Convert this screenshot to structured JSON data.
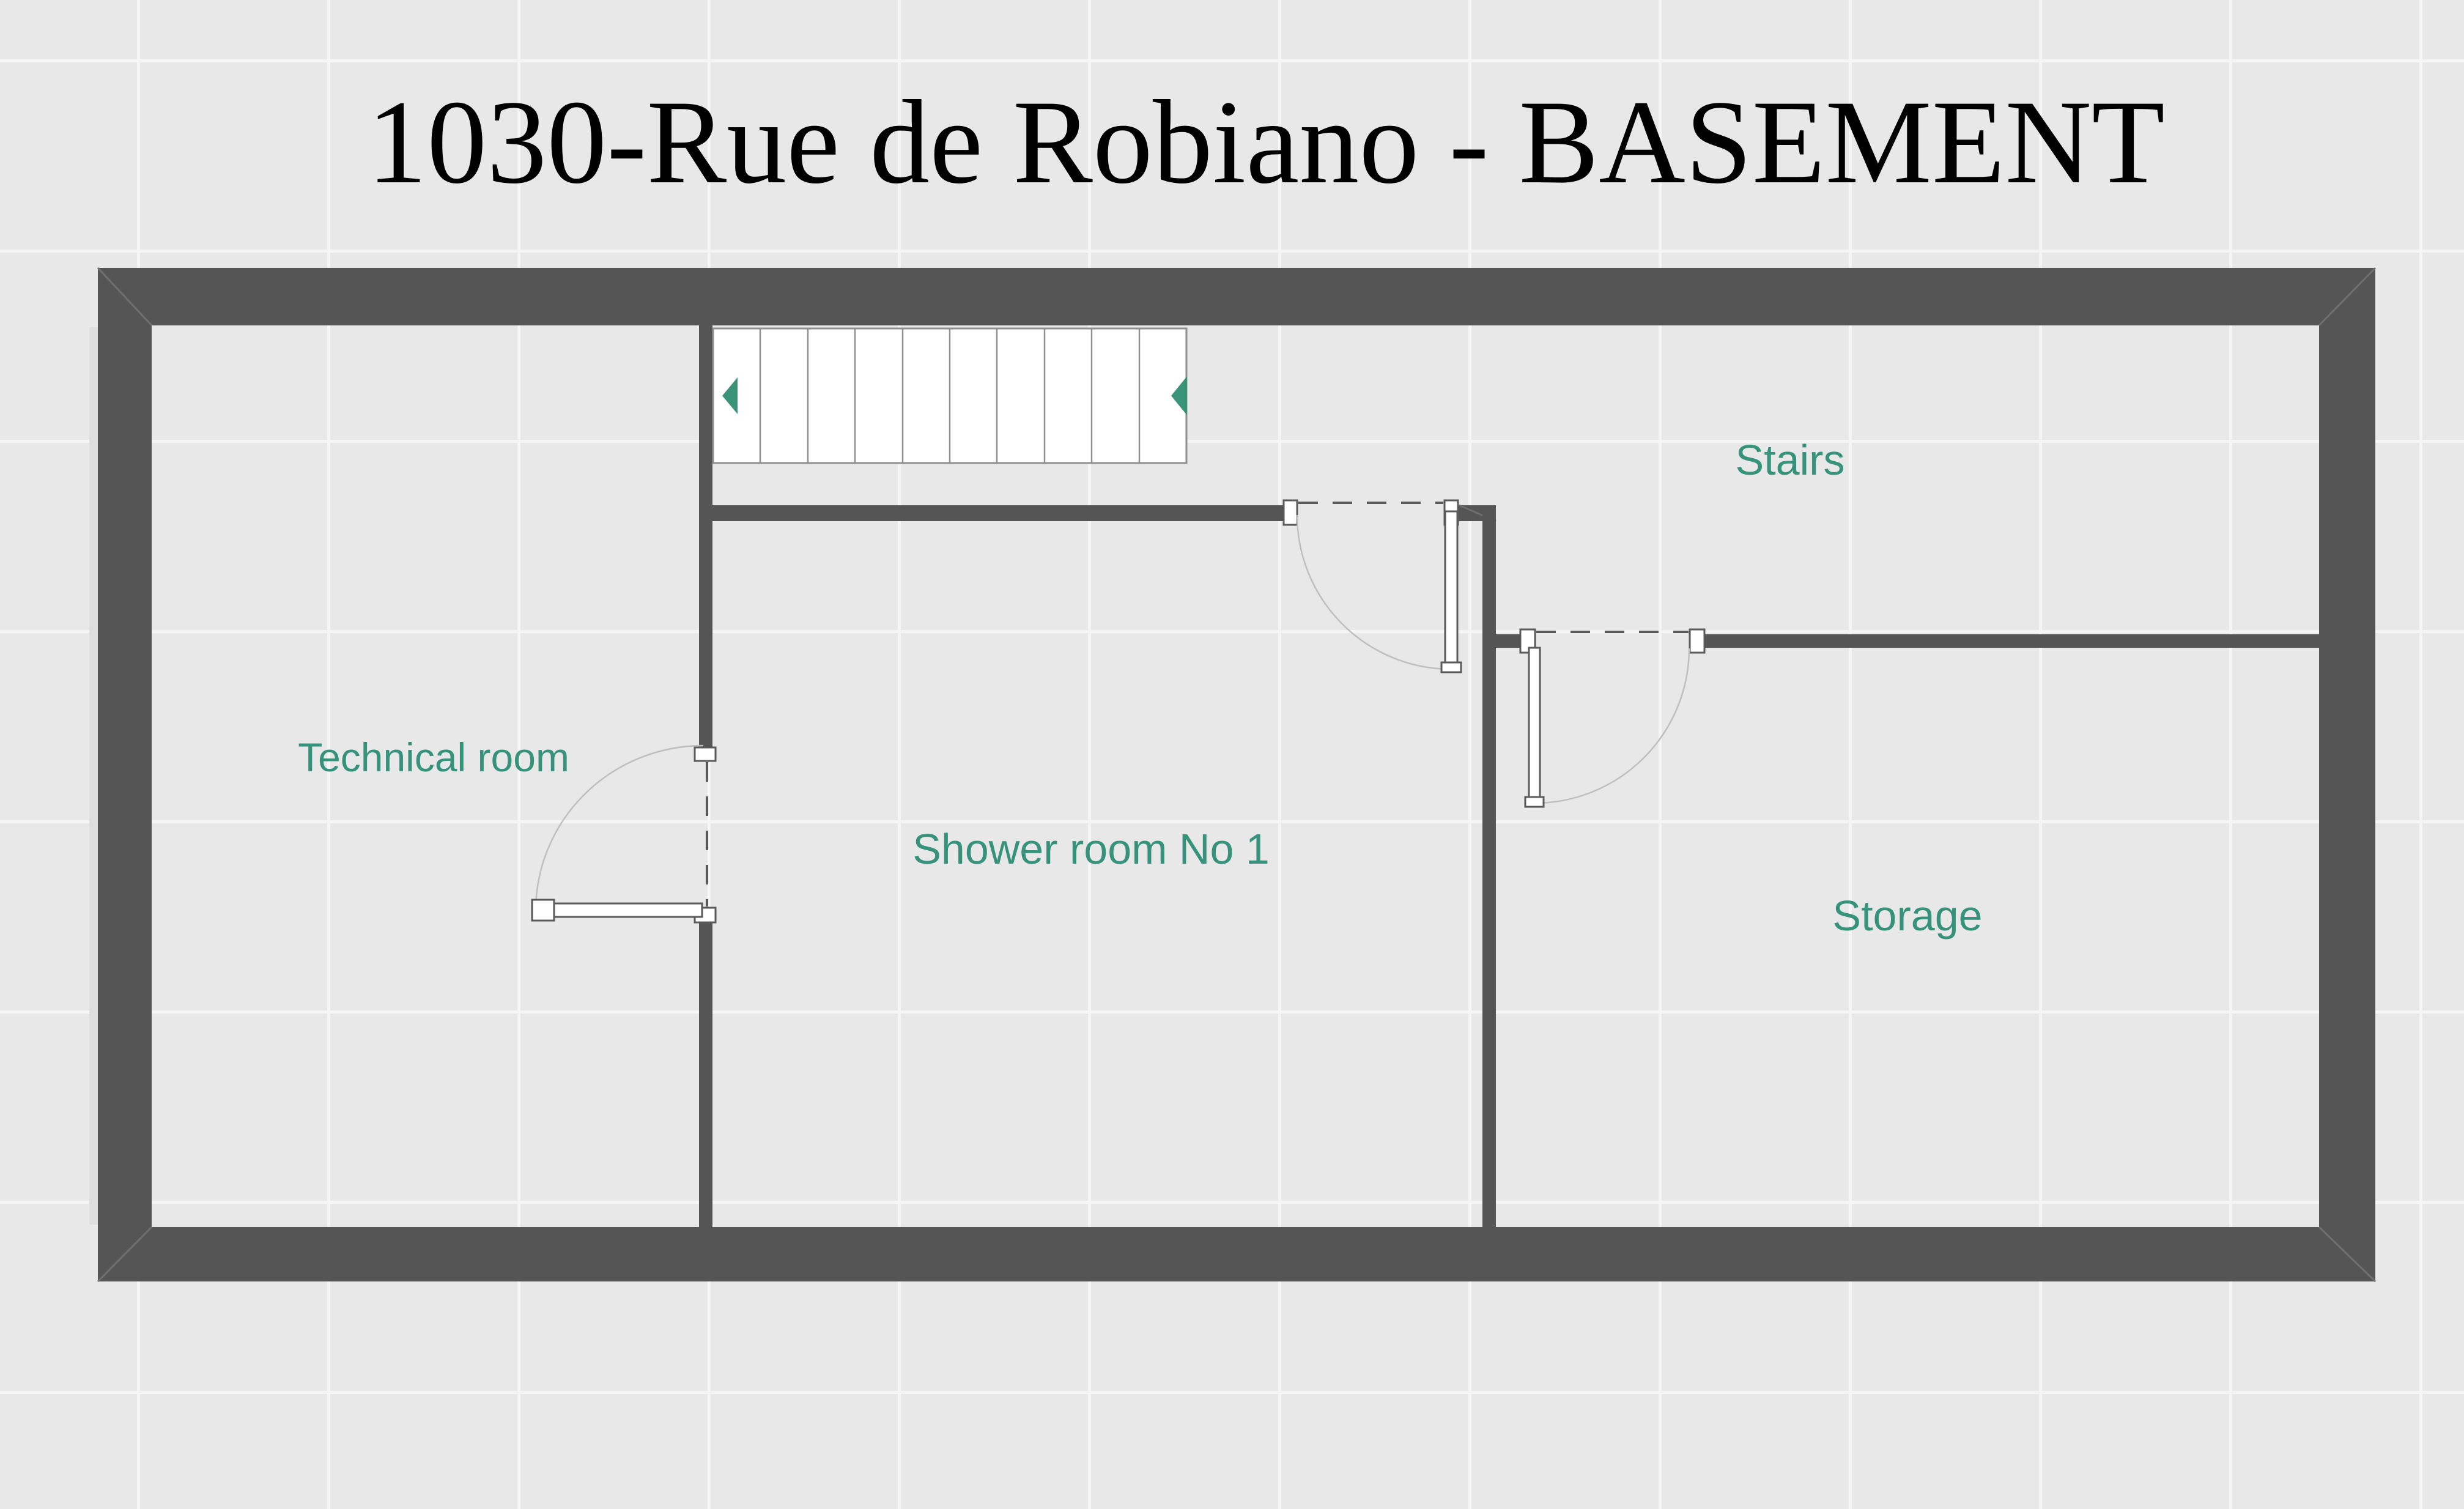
{
  "title": "1030-Rue de Robiano - BASEMENT",
  "rooms": {
    "technical": {
      "label": "Technical room"
    },
    "shower": {
      "label": "Shower room No 1"
    },
    "stairs": {
      "label": "Stairs"
    },
    "storage": {
      "label": "Storage"
    }
  },
  "stairs_feature": {
    "treads": 10,
    "direction_arrows": 2
  },
  "colors": {
    "background": "#e8e8e8",
    "grid_line": "#f5f5f5",
    "wall": "#555555",
    "room_label": "#36927a",
    "title_text": "#000000",
    "stair_arrow": "#3a9478"
  }
}
